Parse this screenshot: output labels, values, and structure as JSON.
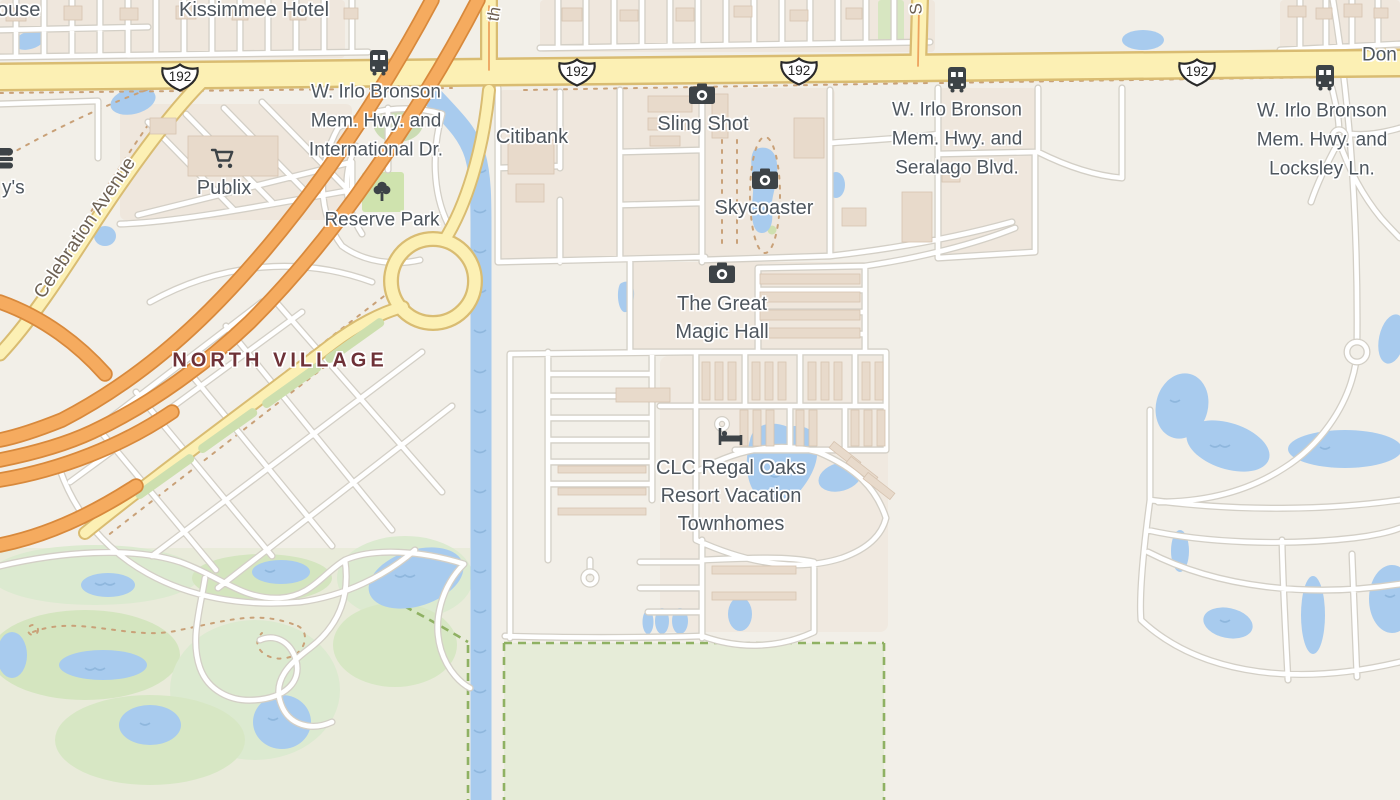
{
  "labels": {
    "partial_house": "ouse",
    "kissimmee_hotel": "Kissimmee Hotel",
    "partial_don": "Don",
    "irlo_international": {
      "lines": [
        "W. Irlo Bronson",
        "Mem. Hwy. and",
        "International Dr."
      ]
    },
    "irlo_seralago": {
      "lines": [
        "W. Irlo Bronson",
        "Mem. Hwy. and",
        "Seralago Blvd."
      ]
    },
    "irlo_locksley": {
      "lines": [
        "W. Irlo Bronson",
        "Mem. Hwy. and",
        "Locksley Ln."
      ]
    },
    "citibank": "Citibank",
    "sling_shot": "Sling Shot",
    "skycoaster": "Skycoaster",
    "publix": "Publix",
    "reserve_park": "Reserve Park",
    "north_village": "NORTH VILLAGE",
    "celebration_avenue": "Celebration Avenue",
    "partial_fastfood": "y's",
    "street_th": "th",
    "street_s": "S",
    "magic_hall": {
      "lines": [
        "The Great",
        "Magic Hall"
      ]
    },
    "regal_oaks": {
      "lines": [
        "CLC Regal Oaks",
        "Resort Vacation",
        "Townhomes"
      ]
    }
  },
  "route_shield": {
    "number": "192"
  },
  "icons": {
    "bus_stop": "bus",
    "attraction": "camera",
    "lodging": "bed",
    "supermarket": "shopping-cart",
    "park": "tree",
    "fast_food": "burger"
  },
  "colors": {
    "background": "#f2efe8",
    "background_green": "#e9ebda",
    "water": "#a8cbee",
    "water_detail": "#8fb7dd",
    "road_motorway": "#f5ab5f",
    "road_motorway_casing": "#d8893c",
    "road_yellow_fill": "#fcf0b4",
    "road_yellow_casing": "#d9bc72",
    "road_minor": "#ffffff",
    "road_minor_casing": "#d3cfc6",
    "landuse_grass": "#d8e7c3",
    "boundary_green": "#8fb163",
    "building": "#e8dacb",
    "label_text": "#4e565e",
    "label_area": "#6e3137",
    "label_street": "#6d6154",
    "icon": "#3d4347"
  }
}
